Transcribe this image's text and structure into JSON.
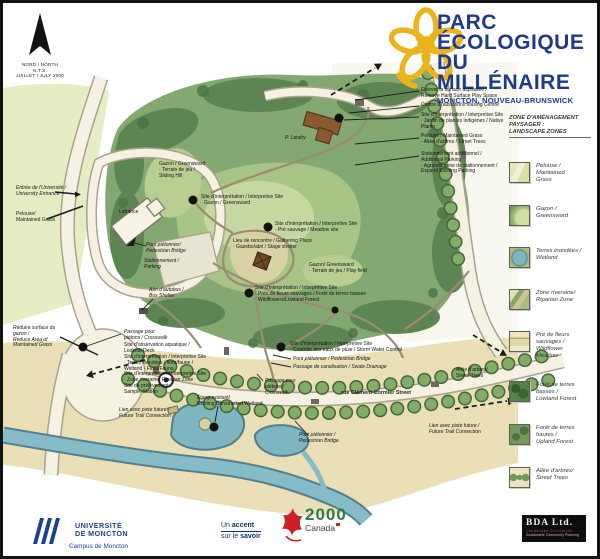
{
  "colors": {
    "title_blue": "#1d3a8c",
    "flower_gold": "#eab41d",
    "park_green": "#83a871",
    "forest_green": "#5d8553",
    "water_blue": "#7db5c0",
    "sand_cream": "#eadfb6",
    "canada_green": "#2d7a4e",
    "canada_red": "#cc2027",
    "udem_blue": "#1d3f94"
  },
  "north": {
    "line1": "NORD / NORTH",
    "line2": "N.T.S.",
    "line3": "JUILLET / JULY 2000"
  },
  "header": {
    "title_line1": "PARC",
    "title_line2": "ÉCOLOGIQUE",
    "title_line3": "DU MILLÉNAIRE",
    "subtitle": "MONCTON, NOUVEAU-BRUNSWICK"
  },
  "legend": {
    "title_line1": "ZONE D'AMÉNAGEMENT",
    "title_line2": "PAYSAGER :",
    "title_line3": "LANDSCAPE ZONES",
    "items": [
      {
        "id": "maintained-grass",
        "label": [
          "Pelouse /",
          "Maintained",
          "Grass"
        ]
      },
      {
        "id": "greensward",
        "label": [
          "Gazon  /",
          "Greensward"
        ]
      },
      {
        "id": "wetland",
        "label": [
          "Terres inondées /",
          "Wetland"
        ]
      },
      {
        "id": "riparian",
        "label": [
          "Zone riveraine/",
          "Riparian Zone"
        ]
      },
      {
        "id": "wildflower",
        "label": [
          "Pré de fleurs",
          "sauvages /",
          "Wildflower",
          "Meadow"
        ]
      },
      {
        "id": "lowland-forest",
        "label": [
          "Forêt de terres",
          "basses /",
          "Lowland Forest"
        ]
      },
      {
        "id": "upland-forest",
        "label": [
          "Forêt de terres",
          "hautes /",
          "Upland  Forest"
        ]
      },
      {
        "id": "street-trees",
        "label": [
          "Allée d'arbres/",
          "Street Trees"
        ]
      }
    ]
  },
  "map": {
    "annotations": [
      {
        "name": "remove-hard-surface",
        "x": 418,
        "y": 85,
        "lines": [
          "Enlever la surface asphaltée /",
          "Remove Hard Surface Play Space"
        ]
      },
      {
        "name": "housing-centre",
        "x": 418,
        "y": 100,
        "lines": [
          "Centre d'habitation/Housing Centre"
        ]
      },
      {
        "name": "interpretive-native-plants",
        "x": 418,
        "y": 110,
        "lines": [
          "Site d'interprétation / Interpretive Site",
          "· Jardin de plantes indigènes / Native",
          "  Plants"
        ]
      },
      {
        "name": "maintained-grass-street-trees",
        "x": 418,
        "y": 131,
        "lines": [
          "Pelouse / Maintained Grass",
          "· Allée d'arbres / Street Trees"
        ]
      },
      {
        "name": "additional-parking",
        "x": 418,
        "y": 149,
        "lines": [
          "Stationnement additionnel /",
          "Additional Parking",
          "· Agrandir zone de stationnement /",
          "  Expand Existing Parking"
        ]
      },
      {
        "name": "building-p-landry",
        "x": 282,
        "y": 133,
        "italic": true,
        "lines": [
          "P. Landry"
        ]
      },
      {
        "name": "university-entrance",
        "x": 13,
        "y": 183,
        "italic": true,
        "lines": [
          "Entrée de l'Université /",
          "University Entrance"
        ]
      },
      {
        "name": "maintained-grass-left",
        "x": 13,
        "y": 209,
        "lines": [
          "Pelouse/",
          "Maintained Grass"
        ]
      },
      {
        "name": "building-lafrance",
        "x": 116,
        "y": 207,
        "lines": [
          "Lafrance"
        ]
      },
      {
        "name": "greensward-sliding-hill",
        "x": 156,
        "y": 159,
        "lines": [
          "Gazon / Greensward",
          "· Terrain de jeu /",
          "  Sliding Hill"
        ]
      },
      {
        "name": "interpretive-greensward",
        "x": 198,
        "y": 192,
        "lines": [
          "Site d'interprétation / Interpretive Site",
          "· Gazon / Greensward"
        ]
      },
      {
        "name": "interpretive-meadow",
        "x": 272,
        "y": 219,
        "lines": [
          "Site d'interprétation / Interpretive Site",
          "· Pré sauvage / Meadow site"
        ]
      },
      {
        "name": "gathering-place",
        "x": 230,
        "y": 236,
        "lines": [
          "Lieu de rencontre / Gathering Place",
          "· Gazebo/abri / Stage shelter"
        ]
      },
      {
        "name": "pedestrian-bridge-1",
        "x": 143,
        "y": 240,
        "italic": true,
        "lines": [
          "Pont piétonnier/",
          "Pedestrian Bridge"
        ]
      },
      {
        "name": "parking",
        "x": 141,
        "y": 256,
        "italic": true,
        "lines": [
          "Stationnement /",
          "Parking"
        ]
      },
      {
        "name": "greensward-play-field",
        "x": 306,
        "y": 260,
        "lines": [
          "Gazon/ Greensward",
          "· Terrain de jeu / Play field"
        ]
      },
      {
        "name": "bus-shelter",
        "x": 146,
        "y": 285,
        "italic": true,
        "lines": [
          "Abri d'autobus /",
          "Bus Shelter"
        ]
      },
      {
        "name": "interpretive-wildflowers",
        "x": 252,
        "y": 283,
        "lines": [
          "Site d'interprétation / Interpretive Site",
          "· Prés de fleurs sauvages / Forêt de terres basses",
          "· Wildflowers/Lowland Forest"
        ]
      },
      {
        "name": "reduce-grass",
        "x": 10,
        "y": 323,
        "italic": true,
        "lines": [
          "Réduire surface du",
          "gazon /",
          "Reduce Area of",
          "Maintained Grass"
        ]
      },
      {
        "name": "crosswalk-1",
        "x": 121,
        "y": 327,
        "italic": true,
        "lines": [
          "Passage pour",
          "piétons / Crosswalk"
        ]
      },
      {
        "name": "lookout-deck",
        "x": 121,
        "y": 340,
        "lines": [
          "Site d'observation aquatique /",
          "Lookout Deck"
        ]
      },
      {
        "name": "interpretive-wetland-flora",
        "x": 121,
        "y": 352,
        "lines": [
          "Site d'interprétation / Interpretive Site",
          "· Terres inondées / flore/faune /",
          "  Wetland · Flora/Fauna"
        ]
      },
      {
        "name": "interpretive-riparian",
        "x": 121,
        "y": 369,
        "lines": [
          "Site d'interprétation / Interpretive Site",
          "· Zone riveraine/ Riparian Zone"
        ]
      },
      {
        "name": "sample-station",
        "x": 121,
        "y": 381,
        "lines": [
          "Site de prélèvement /",
          "Sample Station"
        ]
      },
      {
        "name": "trail-connection-left",
        "x": 116,
        "y": 405,
        "italic": true,
        "lines": [
          "Lien avec piste future /",
          "Future Trail Connection"
        ]
      },
      {
        "name": "existing-wetland",
        "x": 194,
        "y": 393,
        "lines": [
          "Étang existant/",
          "Existing Constructed Wetland"
        ]
      },
      {
        "name": "interpretive-storm-water",
        "x": 287,
        "y": 339,
        "lines": [
          "Site d'interprétation / Interpretive Site",
          "· Contrôle des eaux de pluie / Storm Water Control"
        ]
      },
      {
        "name": "pedestrian-bridge-2",
        "x": 290,
        "y": 354,
        "italic": true,
        "lines": [
          "Pont piétonnier / Pedestrian Bridge"
        ]
      },
      {
        "name": "swale-drainage",
        "x": 290,
        "y": 362,
        "italic": true,
        "lines": [
          "Passage de canalisation / Swale Drainage"
        ]
      },
      {
        "name": "crosswalk-2",
        "x": 262,
        "y": 376,
        "italic": true,
        "lines": [
          "Passage pour",
          "piétons /",
          "Crosswalk"
        ]
      },
      {
        "name": "street-label-cormier",
        "x": 338,
        "y": 388,
        "bold": true,
        "lines": [
          "rue Clément Cormier Street"
        ]
      },
      {
        "name": "street-trees-right",
        "x": 453,
        "y": 365,
        "lines": [
          "Allée d'arbres/",
          "Street Trees"
        ]
      },
      {
        "name": "trail-connection-right",
        "x": 426,
        "y": 421,
        "italic": true,
        "lines": [
          "Lien avec piste future /",
          "Future Trail Connection"
        ]
      },
      {
        "name": "pedestrian-bridge-3",
        "x": 296,
        "y": 430,
        "italic": true,
        "lines": [
          "Pont piétonnier /",
          "Pedestrian Bridge"
        ]
      }
    ],
    "site_dots": [
      {
        "x": 336,
        "y": 115,
        "r": 4.5
      },
      {
        "x": 190,
        "y": 197,
        "r": 4.5
      },
      {
        "x": 265,
        "y": 224,
        "r": 4.5
      },
      {
        "x": 246,
        "y": 290,
        "r": 4.5
      },
      {
        "x": 278,
        "y": 344,
        "r": 4.5
      },
      {
        "x": 80,
        "y": 344,
        "r": 4.5
      },
      {
        "x": 211,
        "y": 424,
        "r": 4.5
      },
      {
        "x": 332,
        "y": 307,
        "r": 3.5
      }
    ]
  },
  "footer": {
    "udem_line1": "UNIVERSITÉ",
    "udem_line2": "DE MONCTON",
    "udem_campus": "Campus de Moncton",
    "tagline_1a": "Un ",
    "tagline_1b": "accent",
    "tagline_2a": "sur le ",
    "tagline_2b": "savoir",
    "canada_2000": "2000",
    "canada_word": "Canada",
    "bda_name": "BDA  Ltd.",
    "bda_sub1": "Landscape  Architects",
    "bda_sub2": "Sustainable Community Planning"
  }
}
